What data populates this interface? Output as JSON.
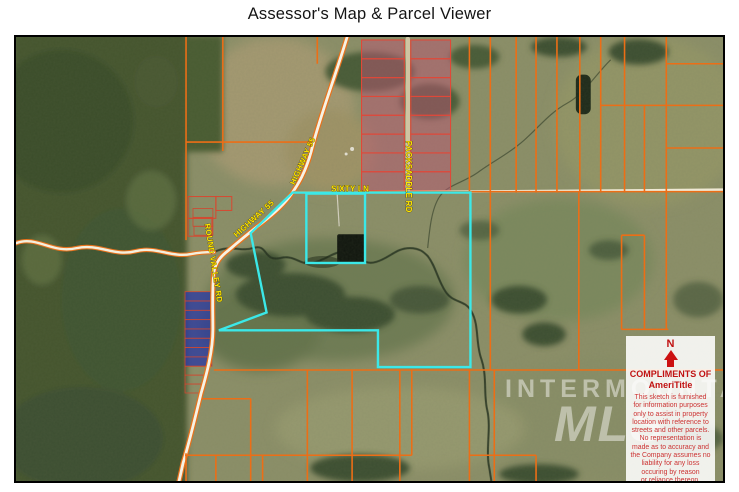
{
  "page": {
    "title": "Assessor's Map & Parcel Viewer"
  },
  "map": {
    "road_labels": {
      "highway": "HIGHWAY 55",
      "sixty_ln": "SIXTY LN",
      "packsaddle": "PACKSADDLE RD",
      "round_valley": "ROUND VALLEY RD"
    },
    "watermark": {
      "line1": "INTERMOUNTAIN",
      "line2": "MLS"
    },
    "info_box": {
      "north_label": "N",
      "compliments_line1": "COMPLIMENTS OF",
      "compliments_line2": "AmeriTitle",
      "disclaimer_lines": [
        "This sketch is furnished",
        "for information purposes",
        "only to assist in property",
        "location with reference to",
        "streets and other parcels.",
        "No representation is",
        "made as to accuracy and",
        "the Company assumes no",
        "liability for any loss",
        "occuring by reason",
        "or reliance thereon."
      ]
    },
    "colors": {
      "parcel_line": "#ec6e16",
      "highlight_parcel": "#3be8e8",
      "road_label": "#ffe600",
      "disclaimer_red": "#c11212",
      "pink_parcel_fill": "#b95573",
      "blue_parcel_fill": "#2b3aa0",
      "forest_green": "#44552f",
      "range_olive": "#8d9069"
    }
  }
}
